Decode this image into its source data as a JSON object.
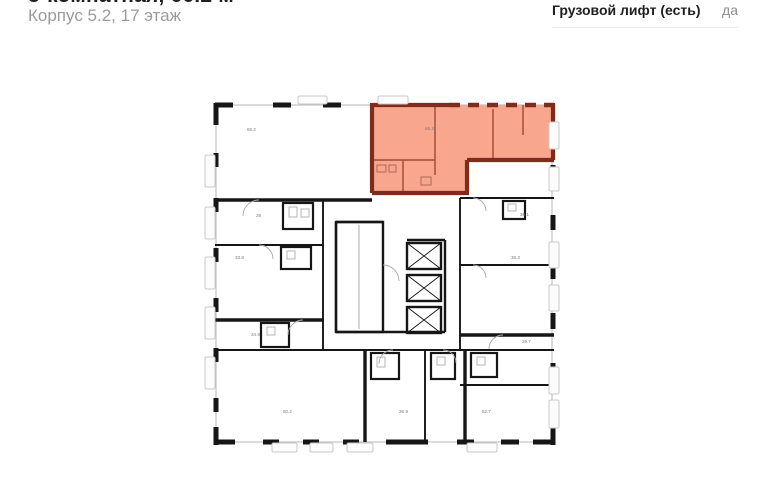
{
  "header": {
    "title": "3-комнатная, 66.2 м²",
    "subtitle": "Корпус 5.2, 17 этаж",
    "spec_label": "Грузовой лифт (есть)",
    "spec_value": "да"
  },
  "floor_plan": {
    "highlight_area": "66.2",
    "highlight_fill": "#F8A68D",
    "highlight_wall_color": "#7E2D1D",
    "wall_color": "#161616",
    "labels": [
      {
        "text": "65.2",
        "x": 44,
        "y": 36
      },
      {
        "text": "66.2",
        "x": 222,
        "y": 35
      },
      {
        "text": "28",
        "x": 53,
        "y": 122
      },
      {
        "text": "33.8",
        "x": 32,
        "y": 164
      },
      {
        "text": "34.9",
        "x": 48,
        "y": 241
      },
      {
        "text": "50.2",
        "x": 80,
        "y": 318
      },
      {
        "text": "36.9",
        "x": 196,
        "y": 318
      },
      {
        "text": "52.7",
        "x": 279,
        "y": 318
      },
      {
        "text": "29.7",
        "x": 319,
        "y": 248
      },
      {
        "text": "36.1",
        "x": 317,
        "y": 121
      },
      {
        "text": "36.3",
        "x": 308,
        "y": 164
      }
    ],
    "balconies": [
      {
        "x": 2,
        "y": 60,
        "w": 10,
        "h": 32
      },
      {
        "x": 2,
        "y": 112,
        "w": 10,
        "h": 32
      },
      {
        "x": 2,
        "y": 162,
        "w": 10,
        "h": 32
      },
      {
        "x": 2,
        "y": 212,
        "w": 10,
        "h": 32
      },
      {
        "x": 2,
        "y": 262,
        "w": 10,
        "h": 32
      },
      {
        "x": 346,
        "y": 27,
        "w": 10,
        "h": 27
      },
      {
        "x": 346,
        "y": 72,
        "w": 10,
        "h": 24
      },
      {
        "x": 346,
        "y": 147,
        "w": 10,
        "h": 26
      },
      {
        "x": 346,
        "y": 190,
        "w": 10,
        "h": 26
      },
      {
        "x": 346,
        "y": 272,
        "w": 10,
        "h": 27
      },
      {
        "x": 346,
        "y": 305,
        "w": 10,
        "h": 28
      },
      {
        "x": 69,
        "y": 348,
        "w": 25,
        "h": 9
      },
      {
        "x": 107,
        "y": 348,
        "w": 23,
        "h": 9
      },
      {
        "x": 144,
        "y": 348,
        "w": 26,
        "h": 9
      },
      {
        "x": 264,
        "y": 348,
        "w": 30,
        "h": 9
      },
      {
        "x": 95,
        "y": 1,
        "w": 29,
        "h": 8
      },
      {
        "x": 175,
        "y": 1,
        "w": 30,
        "h": 8
      }
    ]
  }
}
